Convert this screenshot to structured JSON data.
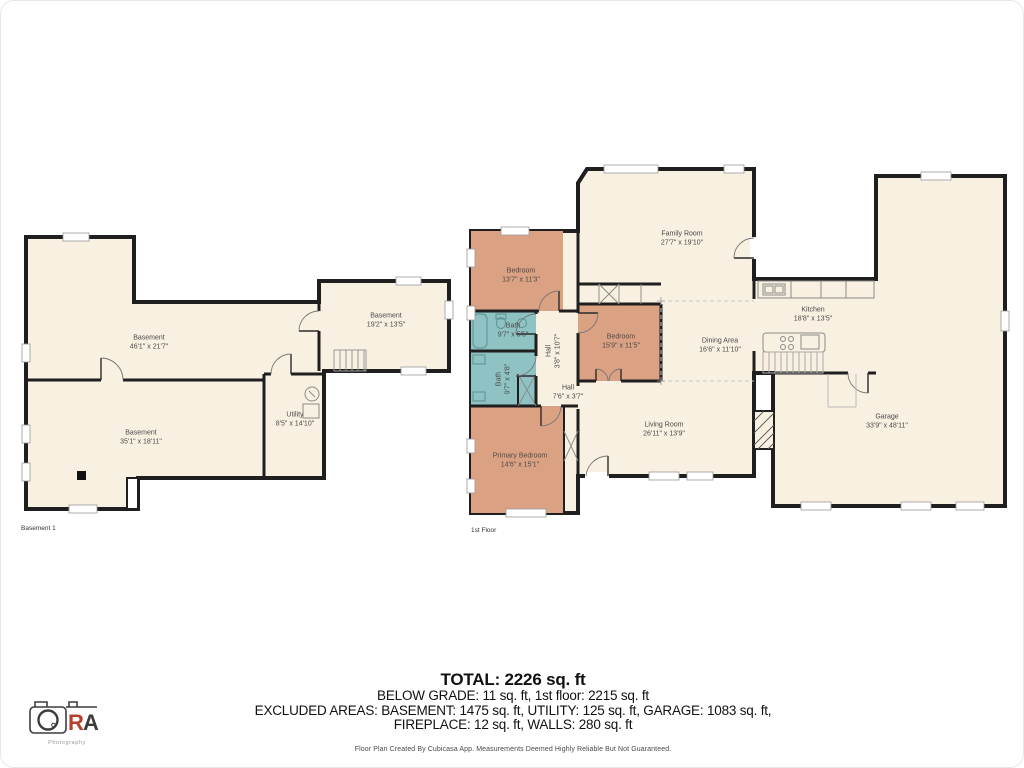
{
  "colors": {
    "floor_fill": "#f8f0e1",
    "bedroom_fill": "#dba183",
    "bath_fill": "#8fc2c2",
    "wall": "#1f1f1f",
    "label_text": "#4a4a4a",
    "logo_accent": "#b5402c"
  },
  "basement": {
    "floor_label": "Basement 1",
    "rooms": [
      {
        "name": "Basement",
        "dims": "46'1\" x 21'7\""
      },
      {
        "name": "Basement",
        "dims": "19'2\" x 13'5\""
      },
      {
        "name": "Basement",
        "dims": "35'1\" x 18'11\""
      },
      {
        "name": "Utility",
        "dims": "8'5\" x 14'10\""
      }
    ]
  },
  "first_floor": {
    "floor_label": "1st Floor",
    "rooms": [
      {
        "name": "Family Room",
        "dims": "27'7\" x 19'10\""
      },
      {
        "name": "Bedroom",
        "dims": "13'7\" x 11'3\""
      },
      {
        "name": "Bath",
        "dims": "9'7\" x 5'5\""
      },
      {
        "name": "Bath",
        "dims": "9'7\" x 4'8\""
      },
      {
        "name": "Hall",
        "dims": "3'8\" x 10'7\""
      },
      {
        "name": "Hall",
        "dims": "7'6\" x 3'7\""
      },
      {
        "name": "Bedroom",
        "dims": "15'9\" x 11'5\""
      },
      {
        "name": "Dining Area",
        "dims": "16'6\" x 11'10\""
      },
      {
        "name": "Kitchen",
        "dims": "18'8\" x 13'5\""
      },
      {
        "name": "Living Room",
        "dims": "26'11\" x 13'9\""
      },
      {
        "name": "Primary Bedroom",
        "dims": "14'6\" x 15'1\""
      },
      {
        "name": "Garage",
        "dims": "33'9\" x 48'11\""
      }
    ]
  },
  "summary": {
    "total": "TOTAL: 2226 sq. ft",
    "line2": "BELOW GRADE: 11 sq. ft, 1st floor: 2215 sq. ft",
    "line3": "EXCLUDED AREAS: BASEMENT: 1475 sq. ft, UTILITY: 125 sq. ft, GARAGE: 1083 sq. ft,",
    "line4": "FIREPLACE: 12 sq. ft, WALLS: 280 sq. ft",
    "disclaimer": "Floor Plan Created By Cubicasa App. Measurements Deemed Highly Reliable But Not Guaranteed."
  },
  "logo": {
    "o": "O",
    "r": "R",
    "a": "A",
    "subtitle": "Photography"
  }
}
